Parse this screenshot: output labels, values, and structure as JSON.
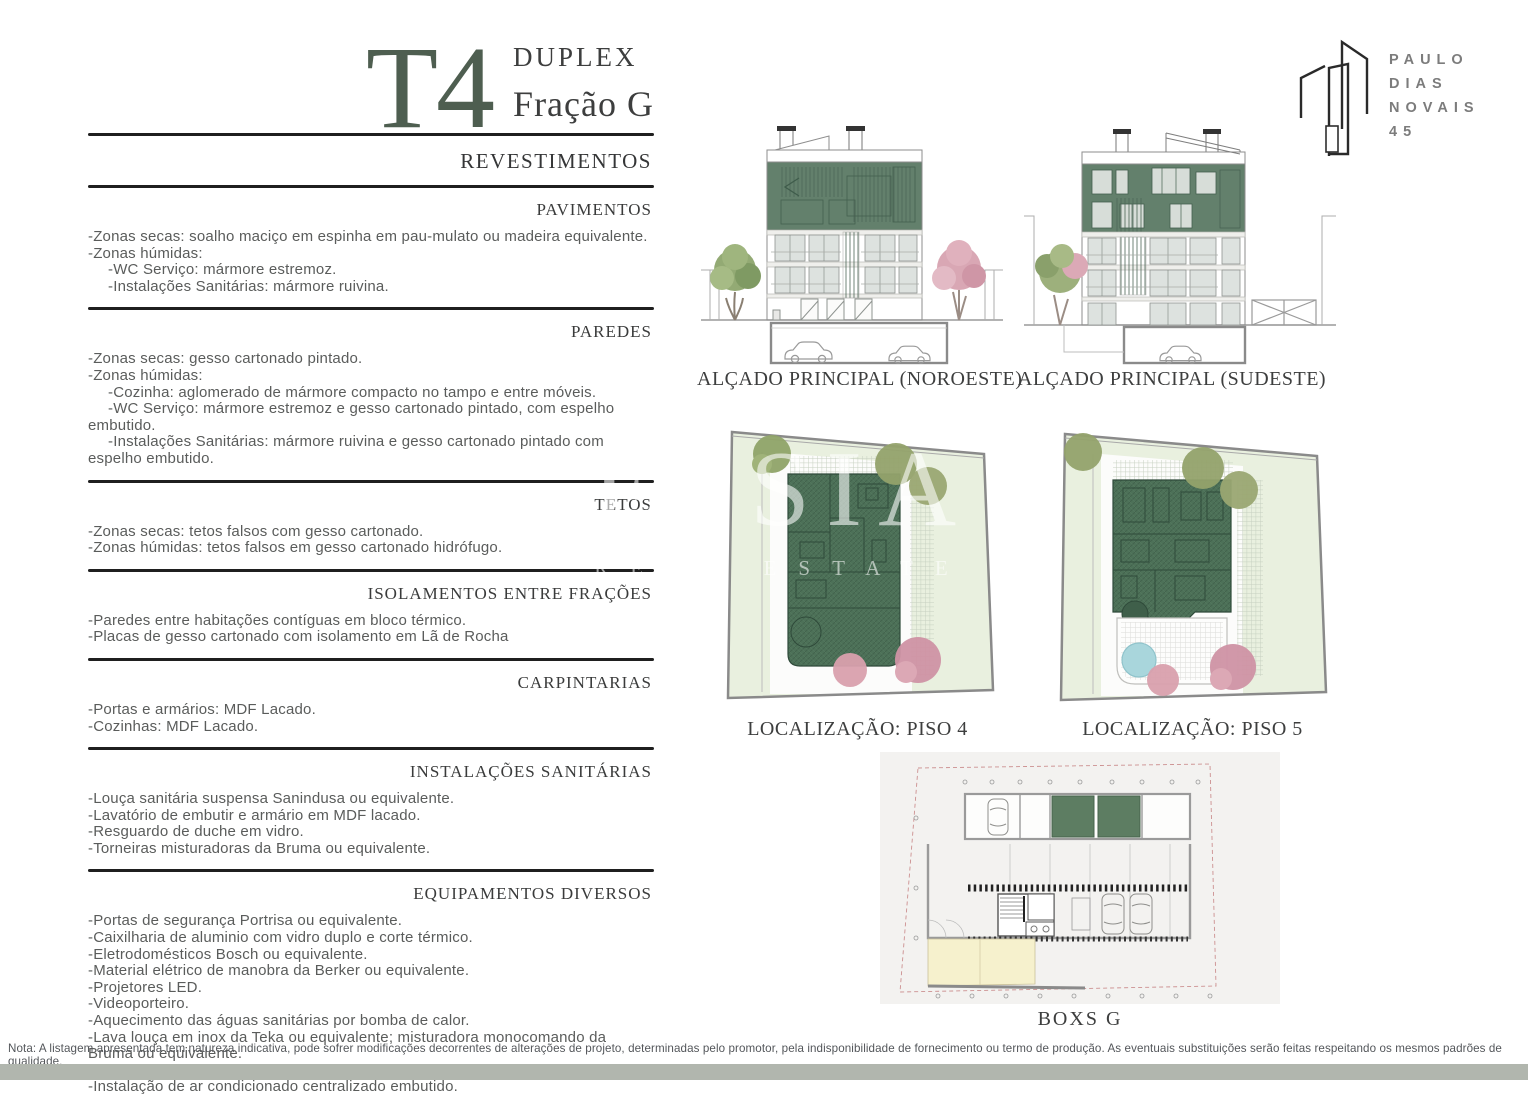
{
  "page": {
    "title_code": "T4",
    "title_type": "DUPLEX",
    "title_fraction": "Fração G",
    "note": "Nota: A listagem apresentada tem natureza indicativa, pode sofrer modificações decorrentes de alterações de projeto, determinadas pelo promotor, pela indisponibilidade de fornecimento ou termo de produção. As eventuais substituições serão feitas respeitando os mesmos padrões de qualidade."
  },
  "logo": {
    "line1": "PAULO",
    "line2": "DIAS",
    "line3": "NOVAIS",
    "line4": "45"
  },
  "specs": {
    "main_heading": "REVESTIMENTOS",
    "sections": [
      {
        "heading": "PAVIMENTOS",
        "items": [
          {
            "text": "-Zonas secas: soalho maciço em espinha em pau-mulato ou madeira equivalente.",
            "indent": 0
          },
          {
            "text": "-Zonas húmidas:",
            "indent": 0
          },
          {
            "text": "-WC Serviço: mármore estremoz.",
            "indent": 1
          },
          {
            "text": "-Instalações Sanitárias: mármore ruivina.",
            "indent": 1
          }
        ]
      },
      {
        "heading": "PAREDES",
        "items": [
          {
            "text": "-Zonas secas: gesso cartonado pintado.",
            "indent": 0
          },
          {
            "text": "-Zonas húmidas:",
            "indent": 0
          },
          {
            "text": "-Cozinha: aglomerado de mármore compacto no tampo e entre móveis.",
            "indent": 1
          },
          {
            "text": "-WC Serviço: mármore estremoz e gesso cartonado pintado, com espelho embutido.",
            "indent": 1
          },
          {
            "text": "-Instalações Sanitárias: mármore ruivina e gesso cartonado pintado com espelho embutido.",
            "indent": 1
          }
        ]
      },
      {
        "heading": "TETOS",
        "items": [
          {
            "text": "-Zonas secas: tetos falsos com gesso cartonado.",
            "indent": 0
          },
          {
            "text": "-Zonas húmidas: tetos falsos em gesso cartonado hidrófugo.",
            "indent": 0
          }
        ]
      },
      {
        "heading": "ISOLAMENTOS ENTRE FRAÇÕES",
        "items": [
          {
            "text": "-Paredes entre habitações contíguas em bloco térmico.",
            "indent": 0
          },
          {
            "text": "-Placas de gesso cartonado com isolamento em Lã de Rocha",
            "indent": 0
          }
        ]
      },
      {
        "heading": "CARPINTARIAS",
        "items": [
          {
            "text": "-Portas e armários: MDF Lacado.",
            "indent": 0
          },
          {
            "text": "-Cozinhas: MDF Lacado.",
            "indent": 0
          }
        ]
      },
      {
        "heading": "INSTALAÇÕES SANITÁRIAS",
        "items": [
          {
            "text": "-Louça sanitária suspensa Sanindusa ou equivalente.",
            "indent": 0
          },
          {
            "text": "-Lavatório de embutir e armário em MDF lacado.",
            "indent": 0
          },
          {
            "text": "-Resguardo de duche em vidro.",
            "indent": 0
          },
          {
            "text": "-Torneiras misturadoras da Bruma ou equivalente.",
            "indent": 0
          }
        ]
      },
      {
        "heading": "EQUIPAMENTOS DIVERSOS",
        "items": [
          {
            "text": "-Portas de segurança Portrisa ou equivalente.",
            "indent": 0
          },
          {
            "text": "-Caixilharia de aluminio com vidro duplo e corte térmico.",
            "indent": 0
          },
          {
            "text": "-Eletrodomésticos Bosch ou equivalente.",
            "indent": 0
          },
          {
            "text": "-Material elétrico de manobra da Berker ou equivalente.",
            "indent": 0
          },
          {
            "text": "-Projetores LED.",
            "indent": 0
          },
          {
            "text": "-Videoporteiro.",
            "indent": 0
          },
          {
            "text": "-Aquecimento das águas sanitárias por bomba de calor.",
            "indent": 0
          },
          {
            "text": "-Lava louça em inox da Teka ou equivalente; misturadora monocomando da Bruma ou equivalente.",
            "indent": 0
          },
          {
            "text": "-Elevadores Orona ou equivalente.",
            "indent": 0
          },
          {
            "text": "-Instalação de ar condicionado centralizado embutido.",
            "indent": 0
          }
        ]
      }
    ]
  },
  "drawings": {
    "elevation_nw_label": "ALÇADO PRINCIPAL (NOROESTE)",
    "elevation_se_label": "ALÇADO PRINCIPAL (SUDESTE)",
    "plan_p4_label": "LOCALIZAÇÃO: PISO 4",
    "plan_p5_label": "LOCALIZAÇÃO: PISO 5",
    "boxes_label": "BOXS G"
  },
  "watermark": {
    "line1": "ESSIA",
    "line2": "REAL ESTATE"
  },
  "colors": {
    "title_green": "#4e5e50",
    "facade_green": "#63806c",
    "plan_green": "#4d7158",
    "ground_light_green": "#e7eedd",
    "tree_pink": "#d9a7b4",
    "tree_olive": "#95a46f",
    "pool_blue": "#a9d6dc",
    "boxs_yellow": "#f6f1cd",
    "boxs_panel_gray": "#f3f2f0",
    "bottom_band": "#b1b6ae",
    "logo_gray": "#7c7c7c"
  }
}
